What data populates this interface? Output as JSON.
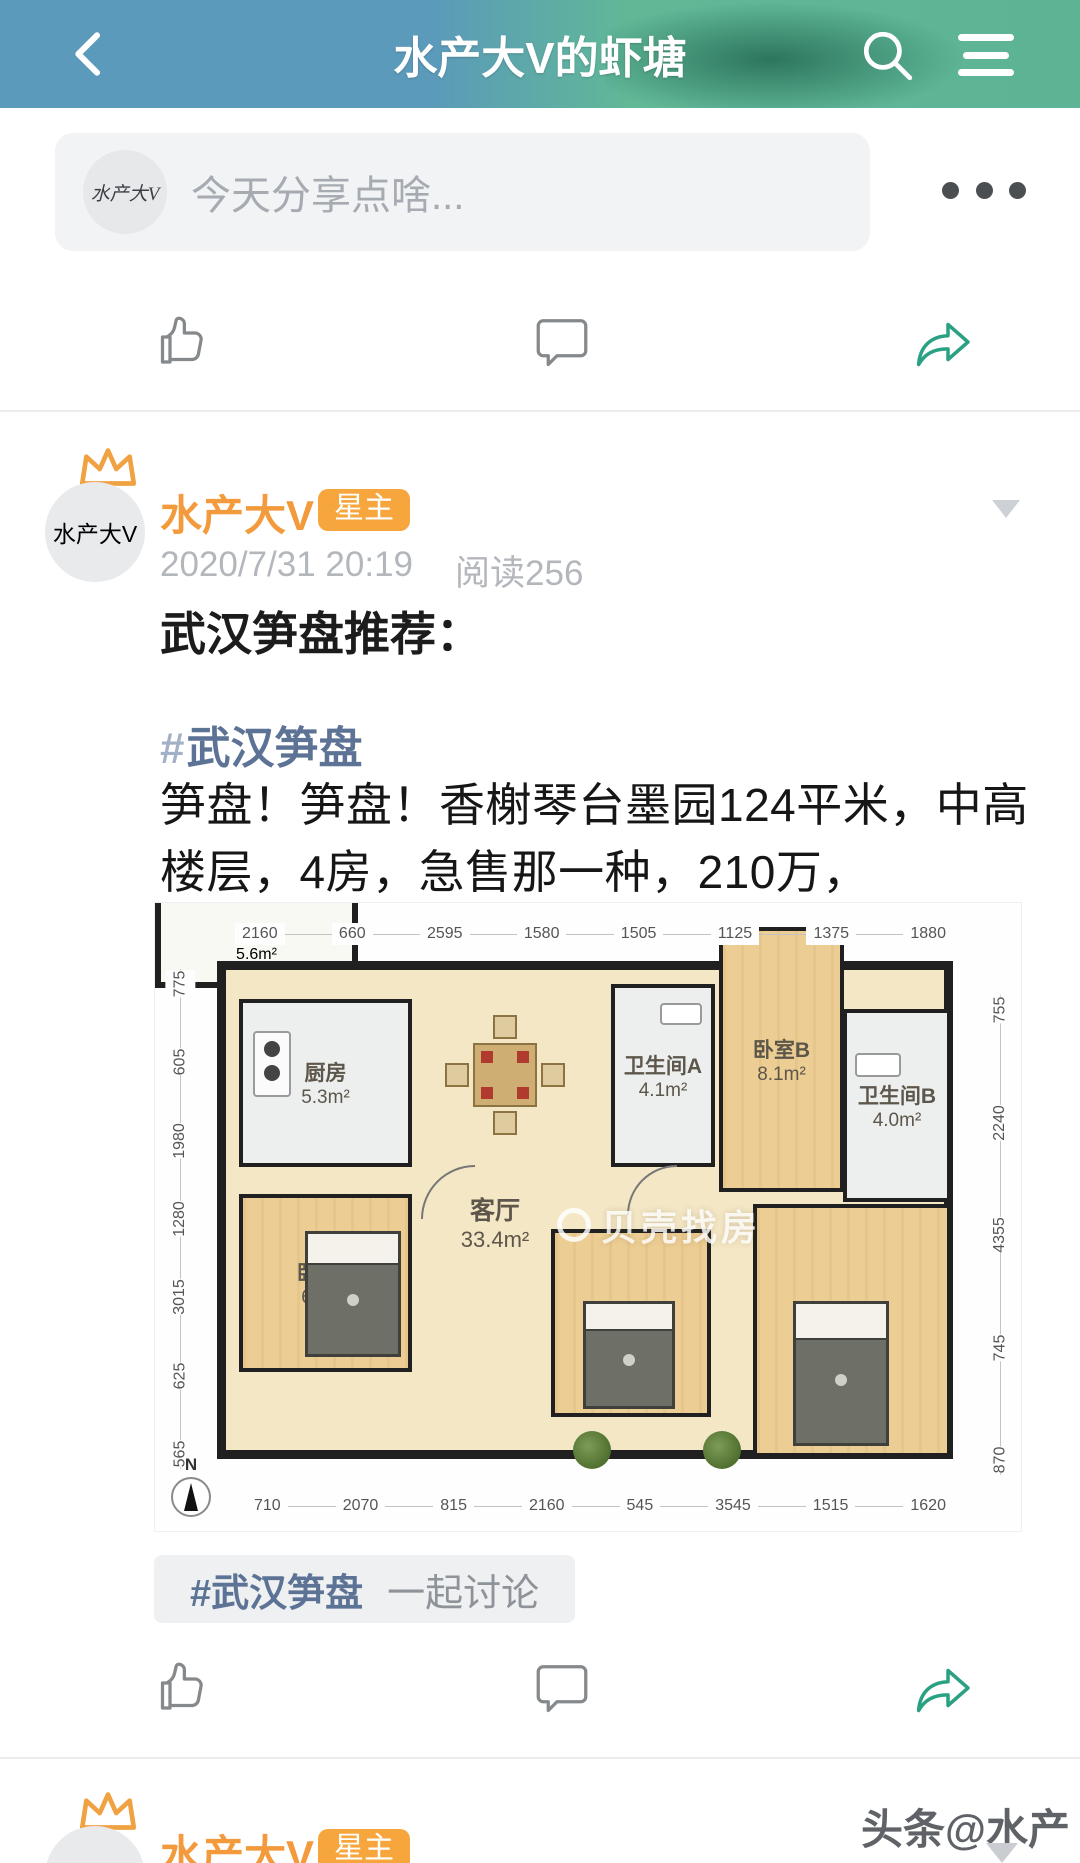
{
  "header": {
    "title": "水产大V的虾塘"
  },
  "composer": {
    "placeholder": "今天分享点啥...",
    "avatar_text": "水产大V"
  },
  "post": {
    "author": "水产大V",
    "badge": "星主",
    "avatar_text": "水产大V",
    "datetime": "2020/7/31 20:19",
    "read_count": "阅读256",
    "title": "武汉笋盘推荐：",
    "hashtag_mark": "#",
    "hashtag": "武汉笋盘",
    "body": "笋盘！笋盘！香榭琴台墨园124平米，中高楼层，4房，急售那一种，210万，",
    "tag_bar": {
      "hashtag": "#武汉笋盘",
      "suffix": "一起讨论"
    }
  },
  "floorplan": {
    "dims_top": [
      "2160",
      "660",
      "2595",
      "1580",
      "1505",
      "1125",
      "1375",
      "1880"
    ],
    "dims_bottom": [
      "710",
      "2070",
      "815",
      "2160",
      "545",
      "3545",
      "1515",
      "1620"
    ],
    "dims_left": [
      "775",
      "605",
      "1980",
      "1280",
      "3015",
      "625",
      "565"
    ],
    "dims_right": [
      "755",
      "2240",
      "4355",
      "745",
      "870"
    ],
    "rooms": {
      "kitchen": {
        "label": "厨房",
        "area": "5.3m²"
      },
      "bathA": {
        "label": "卫生间A",
        "area": "4.1m²"
      },
      "bedB": {
        "label": "卧室B",
        "area": "8.1m²"
      },
      "bathB": {
        "label": "卫生间B",
        "area": "4.0m²"
      },
      "living": {
        "label": "客厅",
        "area": "33.4m²"
      },
      "bedA": {
        "label": "卧室A",
        "area": "6.2m²"
      },
      "bedD": {
        "label": "卧室D",
        "area": "9.9m²"
      },
      "bedC": {
        "label": "卧室C",
        "area": "16.1m²"
      },
      "balcony": {
        "label": "阳台",
        "area": "5.6m²"
      }
    },
    "compass_label": "N",
    "watermark": "贝壳找房"
  },
  "post2": {
    "author": "水产大V",
    "badge": "星主",
    "avatar_text": "水产大V"
  },
  "page_watermark": "头条@水产大V",
  "colors": {
    "header_blue": "#5b9aba",
    "header_green": "#5cb495",
    "header_green_dark": "#1f6653",
    "accent_orange": "#f5a33d",
    "hashtag_blue": "#5d7396",
    "share_green": "#2ba184",
    "icon_gray": "#85898c"
  }
}
